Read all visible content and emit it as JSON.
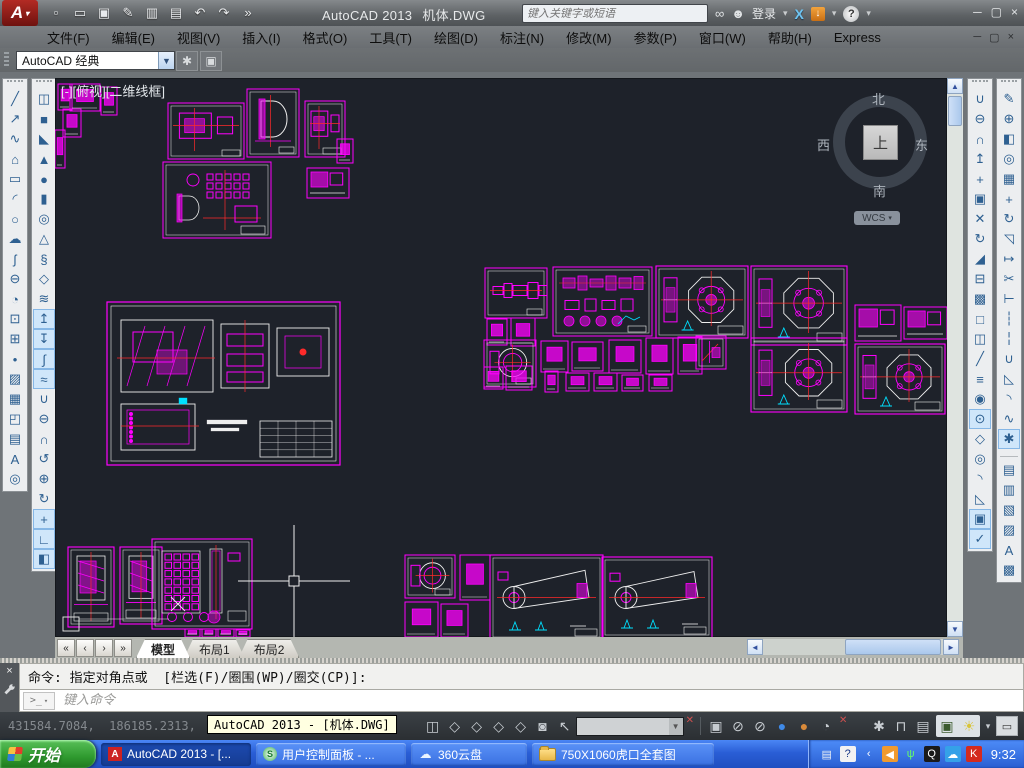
{
  "titlebar": {
    "app": "AutoCAD 2013",
    "doc": "机体.DWG",
    "search_placeholder": "键入关键字或短语",
    "signin": "登录",
    "help": "?",
    "exchange": "X",
    "quick_access": [
      {
        "name": "new",
        "g": "▫"
      },
      {
        "name": "open",
        "g": "▭"
      },
      {
        "name": "save",
        "g": "▣"
      },
      {
        "name": "save-as",
        "g": "✎"
      },
      {
        "name": "plot-preview",
        "g": "▥"
      },
      {
        "name": "plot",
        "g": "▤"
      },
      {
        "name": "undo",
        "g": "↶"
      },
      {
        "name": "redo",
        "g": "↷"
      },
      {
        "name": "more-tools",
        "g": "»"
      }
    ],
    "window_controls": [
      {
        "name": "minimize",
        "g": "─"
      },
      {
        "name": "restore",
        "g": "▢"
      },
      {
        "name": "close",
        "g": "×"
      }
    ]
  },
  "menubar": {
    "items": [
      "文件(F)",
      "编辑(E)",
      "视图(V)",
      "插入(I)",
      "格式(O)",
      "工具(T)",
      "绘图(D)",
      "标注(N)",
      "修改(M)",
      "参数(P)",
      "窗口(W)",
      "帮助(H)",
      "Express"
    ],
    "child_controls": [
      {
        "name": "child-minimize",
        "g": "─"
      },
      {
        "name": "child-restore",
        "g": "▢"
      },
      {
        "name": "child-close",
        "g": "×"
      }
    ]
  },
  "workspace": {
    "value": "AutoCAD 经典",
    "gear": "✱",
    "settings": "▣"
  },
  "toolbars": {
    "draw": [
      {
        "name": "line",
        "g": "╱"
      },
      {
        "name": "construction-line",
        "g": "↗"
      },
      {
        "name": "polyline",
        "g": "∿"
      },
      {
        "name": "polygon",
        "g": "⌂"
      },
      {
        "name": "rectangle",
        "g": "▭"
      },
      {
        "name": "arc",
        "g": "◜"
      },
      {
        "name": "circle",
        "g": "○"
      },
      {
        "name": "revision-cloud",
        "g": "☁"
      },
      {
        "name": "spline",
        "g": "ʃ"
      },
      {
        "name": "ellipse",
        "g": "⊖"
      },
      {
        "name": "ellipse-arc",
        "g": "◔"
      },
      {
        "name": "insert-block",
        "g": "⊡"
      },
      {
        "name": "make-block",
        "g": "⊞"
      },
      {
        "name": "point",
        "g": "•"
      },
      {
        "name": "hatch",
        "g": "▨"
      },
      {
        "name": "gradient",
        "g": "▦"
      },
      {
        "name": "region",
        "g": "◰"
      },
      {
        "name": "table",
        "g": "▤"
      },
      {
        "name": "multiline-text",
        "g": "A"
      },
      {
        "name": "group",
        "g": "◎"
      }
    ],
    "modeling": [
      {
        "name": "polysolid",
        "g": "◫"
      },
      {
        "name": "box",
        "g": "■"
      },
      {
        "name": "wedge",
        "g": "◣"
      },
      {
        "name": "cone",
        "g": "▲"
      },
      {
        "name": "sphere",
        "g": "●"
      },
      {
        "name": "cylinder",
        "g": "▮"
      },
      {
        "name": "torus",
        "g": "◎"
      },
      {
        "name": "pyramid",
        "g": "△"
      },
      {
        "name": "helix",
        "g": "§"
      },
      {
        "name": "planar-surface",
        "g": "◇"
      },
      {
        "name": "surface-network",
        "g": "≋"
      },
      {
        "name": "extrude",
        "g": "↥",
        "hl": true
      },
      {
        "name": "presspull",
        "g": "↧",
        "hl": true
      },
      {
        "name": "sweep",
        "g": "∫",
        "hl": true
      },
      {
        "name": "loft",
        "g": "≈",
        "hl": true
      },
      {
        "name": "union",
        "g": "∪"
      },
      {
        "name": "subtract",
        "g": "⊖"
      },
      {
        "name": "intersect",
        "g": "∩"
      },
      {
        "name": "constrained-orbit",
        "g": "↺"
      },
      {
        "name": "free-orbit",
        "g": "⊕"
      },
      {
        "name": "continuous-orbit",
        "g": "↻"
      },
      {
        "name": "3d-move",
        "g": "+",
        "hl": true
      },
      {
        "name": "3d-rotate",
        "g": "∟",
        "hl": true
      },
      {
        "name": "3d-align",
        "g": "◧",
        "hl": true
      }
    ],
    "solid_edit": [
      {
        "name": "union",
        "g": "∪"
      },
      {
        "name": "subtract",
        "g": "⊖"
      },
      {
        "name": "intersect",
        "g": "∩"
      },
      {
        "name": "extrude-faces",
        "g": "↥"
      },
      {
        "name": "move-faces",
        "g": "+"
      },
      {
        "name": "offset-faces",
        "g": "▣"
      },
      {
        "name": "delete-faces",
        "g": "✕"
      },
      {
        "name": "rotate-faces",
        "g": "↻"
      },
      {
        "name": "taper-faces",
        "g": "◢"
      },
      {
        "name": "copy-faces",
        "g": "⊟"
      },
      {
        "name": "color-faces",
        "g": "▩"
      },
      {
        "name": "shell",
        "g": "□"
      },
      {
        "name": "separate",
        "g": "◫"
      },
      {
        "name": "slice",
        "g": "╱"
      },
      {
        "name": "thicken",
        "g": "≡"
      },
      {
        "name": "interfere",
        "g": "◉"
      },
      {
        "name": "imprint",
        "g": "⊙",
        "hl": true
      },
      {
        "name": "extract-edges",
        "g": "◇"
      },
      {
        "name": "offset-edges",
        "g": "◎"
      },
      {
        "name": "fillet-edge",
        "g": "◝"
      },
      {
        "name": "chamfer-edge",
        "g": "◺"
      },
      {
        "name": "convert-to-solid",
        "g": "▣",
        "hl": true
      },
      {
        "name": "check",
        "g": "✓",
        "hl": true
      }
    ],
    "modify": [
      {
        "name": "erase",
        "g": "✎"
      },
      {
        "name": "copy",
        "g": "⊕"
      },
      {
        "name": "mirror",
        "g": "◧"
      },
      {
        "name": "offset",
        "g": "◎"
      },
      {
        "name": "array",
        "g": "▦"
      },
      {
        "name": "move",
        "g": "+"
      },
      {
        "name": "rotate",
        "g": "↻"
      },
      {
        "name": "scale",
        "g": "◹"
      },
      {
        "name": "stretch",
        "g": "↦"
      },
      {
        "name": "trim",
        "g": "✂"
      },
      {
        "name": "extend",
        "g": "⊢"
      },
      {
        "name": "break-at-point",
        "g": "┆"
      },
      {
        "name": "break",
        "g": "╎"
      },
      {
        "name": "join",
        "g": "∪"
      },
      {
        "name": "chamfer",
        "g": "◺"
      },
      {
        "name": "fillet",
        "g": "◝"
      },
      {
        "name": "blend-curves",
        "g": "∿"
      },
      {
        "name": "explode",
        "g": "✱",
        "hl": true
      }
    ],
    "draw_order": [
      {
        "name": "bring-to-front",
        "g": "▤"
      },
      {
        "name": "send-to-back",
        "g": "▥"
      },
      {
        "name": "bring-above",
        "g": "▧"
      },
      {
        "name": "send-under",
        "g": "▨"
      },
      {
        "name": "text-to-front",
        "g": "A"
      },
      {
        "name": "hatch-to-back",
        "g": "▩"
      }
    ]
  },
  "canvas": {
    "viewport_label": "[-][俯视][二维线框]",
    "viewcube": {
      "north": "北",
      "south": "南",
      "east": "东",
      "west": "西",
      "top": "上",
      "wcs": "WCS"
    },
    "colors": {
      "bg": "#1e222a",
      "magenta": "#ff00ff",
      "white": "#eeeeee",
      "red": "#ff2a2a",
      "cyan": "#00e0ff"
    },
    "crosshair": {
      "x": 239,
      "y": 503
    },
    "zoom_box": {
      "x": 8,
      "y": 539,
      "w": 16,
      "h": 14
    },
    "x_mark": {
      "x": 123,
      "y": 526
    },
    "sheets": [
      {
        "x": 3,
        "y": 6,
        "w": 14,
        "h": 26,
        "m": "tiny"
      },
      {
        "x": 15,
        "y": 6,
        "w": 30,
        "h": 27,
        "m": "tiny"
      },
      {
        "x": 46,
        "y": 9,
        "w": 16,
        "h": 28,
        "m": "tiny"
      },
      {
        "x": 8,
        "y": 31,
        "w": 18,
        "h": 28,
        "m": "tiny"
      },
      {
        "x": 0,
        "y": 52,
        "w": 10,
        "h": 38,
        "m": "tiny"
      },
      {
        "x": 113,
        "y": 25,
        "w": 76,
        "h": 56,
        "m": "views"
      },
      {
        "x": 192,
        "y": 11,
        "w": 52,
        "h": 68,
        "m": "dshape"
      },
      {
        "x": 250,
        "y": 23,
        "w": 40,
        "h": 56,
        "m": "views"
      },
      {
        "x": 282,
        "y": 61,
        "w": 16,
        "h": 24,
        "m": "tiny"
      },
      {
        "x": 108,
        "y": 84,
        "w": 108,
        "h": 76,
        "m": "views2"
      },
      {
        "x": 252,
        "y": 90,
        "w": 42,
        "h": 30,
        "m": "tinywide"
      },
      {
        "x": 52,
        "y": 224,
        "w": 233,
        "h": 163,
        "m": "assembly"
      },
      {
        "x": 430,
        "y": 190,
        "w": 62,
        "h": 50,
        "m": "shaft"
      },
      {
        "x": 432,
        "y": 241,
        "w": 20,
        "h": 26,
        "m": "tiny"
      },
      {
        "x": 456,
        "y": 240,
        "w": 24,
        "h": 28,
        "m": "tiny"
      },
      {
        "x": 498,
        "y": 189,
        "w": 99,
        "h": 69,
        "m": "parts"
      },
      {
        "x": 601,
        "y": 188,
        "w": 92,
        "h": 72,
        "m": "octagon"
      },
      {
        "x": 696,
        "y": 188,
        "w": 96,
        "h": 79,
        "m": "octagon"
      },
      {
        "x": 800,
        "y": 227,
        "w": 46,
        "h": 36,
        "m": "tinywide"
      },
      {
        "x": 849,
        "y": 229,
        "w": 43,
        "h": 32,
        "m": "tinywide"
      },
      {
        "x": 429,
        "y": 262,
        "w": 52,
        "h": 47,
        "m": "circle"
      },
      {
        "x": 486,
        "y": 263,
        "w": 27,
        "h": 31,
        "m": "tiny"
      },
      {
        "x": 517,
        "y": 264,
        "w": 31,
        "h": 29,
        "m": "tiny"
      },
      {
        "x": 554,
        "y": 262,
        "w": 32,
        "h": 33,
        "m": "tiny"
      },
      {
        "x": 591,
        "y": 260,
        "w": 27,
        "h": 36,
        "m": "tiny"
      },
      {
        "x": 623,
        "y": 259,
        "w": 24,
        "h": 37,
        "m": "tiny"
      },
      {
        "x": 641,
        "y": 258,
        "w": 30,
        "h": 33,
        "m": "diag"
      },
      {
        "x": 696,
        "y": 260,
        "w": 96,
        "h": 74,
        "m": "octagon"
      },
      {
        "x": 800,
        "y": 266,
        "w": 90,
        "h": 70,
        "m": "octagon"
      },
      {
        "x": 429,
        "y": 289,
        "w": 19,
        "h": 22,
        "m": "tiny"
      },
      {
        "x": 451,
        "y": 288,
        "w": 26,
        "h": 24,
        "m": "tiny"
      },
      {
        "x": 490,
        "y": 293,
        "w": 13,
        "h": 21,
        "m": "tiny"
      },
      {
        "x": 511,
        "y": 295,
        "w": 23,
        "h": 18,
        "m": "tiny"
      },
      {
        "x": 539,
        "y": 295,
        "w": 23,
        "h": 18,
        "m": "tiny"
      },
      {
        "x": 567,
        "y": 297,
        "w": 21,
        "h": 16,
        "m": "tiny"
      },
      {
        "x": 594,
        "y": 297,
        "w": 23,
        "h": 16,
        "m": "tiny"
      },
      {
        "x": 13,
        "y": 469,
        "w": 46,
        "h": 80,
        "m": "tallpart"
      },
      {
        "x": 65,
        "y": 469,
        "w": 42,
        "h": 77,
        "m": "tallpart"
      },
      {
        "x": 97,
        "y": 461,
        "w": 100,
        "h": 90,
        "m": "gridpart"
      },
      {
        "x": 130,
        "y": 551,
        "w": 15,
        "h": 8,
        "m": "tiny"
      },
      {
        "x": 147,
        "y": 551,
        "w": 14,
        "h": 8,
        "m": "tiny"
      },
      {
        "x": 163,
        "y": 551,
        "w": 16,
        "h": 8,
        "m": "tiny"
      },
      {
        "x": 181,
        "y": 552,
        "w": 14,
        "h": 7,
        "m": "tiny"
      },
      {
        "x": 350,
        "y": 477,
        "w": 50,
        "h": 43,
        "m": "circle"
      },
      {
        "x": 405,
        "y": 477,
        "w": 30,
        "h": 45,
        "m": "tiny"
      },
      {
        "x": 435,
        "y": 477,
        "w": 113,
        "h": 85,
        "m": "wedge"
      },
      {
        "x": 547,
        "y": 479,
        "w": 110,
        "h": 81,
        "m": "wedge"
      },
      {
        "x": 350,
        "y": 524,
        "w": 33,
        "h": 35,
        "m": "tiny"
      },
      {
        "x": 386,
        "y": 526,
        "w": 27,
        "h": 33,
        "m": "tiny"
      }
    ]
  },
  "scrollbars": {
    "up": "▲",
    "down": "▼",
    "left": "◄",
    "right": "►"
  },
  "tabs": {
    "items": [
      "模型",
      "布局1",
      "布局2"
    ],
    "active": 0,
    "nav": [
      "«",
      "‹",
      "›",
      "»"
    ]
  },
  "command": {
    "history": "命令: 指定对角点或  [栏选(F)/圈围(WP)/圈交(CP)]:",
    "prompt": ">_",
    "input_placeholder": "键入命令",
    "close": "×"
  },
  "statusbar": {
    "coords": "431584.7084,  186185.2313,  0.0000",
    "tooltip": "AutoCAD 2013 - [机体.DWG]",
    "left_icons": [
      {
        "name": "annotation-cube",
        "g": "◫"
      },
      {
        "name": "isoplane-1",
        "g": "◇"
      },
      {
        "name": "isoplane-2",
        "g": "◇"
      },
      {
        "name": "isoplane-3",
        "g": "◇"
      },
      {
        "name": "isoplane-4",
        "g": "◇"
      },
      {
        "name": "quickview-camera",
        "g": "◙"
      },
      {
        "name": "pan-zoom",
        "g": "↖"
      }
    ],
    "combo_value": "",
    "mid_icons": [
      {
        "name": "viewport-overlap",
        "g": "▣"
      },
      {
        "name": "isolate-objects",
        "g": "⊘"
      },
      {
        "name": "hide-objects",
        "g": "⊘"
      },
      {
        "name": "sphere-blue",
        "g": "●",
        "c": "#3f8ae8"
      },
      {
        "name": "sphere-orange",
        "g": "●",
        "c": "#d98a3a"
      },
      {
        "name": "annotation-scale",
        "g": "◔"
      }
    ],
    "right_icons": [
      {
        "name": "workspace-gear",
        "g": "✱"
      },
      {
        "name": "toolbar-lock",
        "g": "⊓"
      },
      {
        "name": "hardware-accel",
        "g": "▤"
      }
    ],
    "hl_icons": [
      {
        "name": "capture-check",
        "g": "▣"
      },
      {
        "name": "status-bulb",
        "g": "☀",
        "c": "#d8c43a"
      }
    ],
    "caret": "▾",
    "clean_screen": "▭"
  },
  "taskbar": {
    "start": "开始",
    "tasks": [
      {
        "label": "AutoCAD 2013 - [...",
        "icon": "acad",
        "active": true,
        "w": 150
      },
      {
        "label": "用户控制面板 - ...",
        "icon": "shield",
        "active": false,
        "w": 150
      },
      {
        "label": "360云盘",
        "icon": "cloud",
        "active": false,
        "w": 116
      },
      {
        "label": "750X1060虎口全套图",
        "icon": "folder",
        "active": false,
        "w": 182
      }
    ],
    "tray": [
      {
        "name": "keyboard",
        "g": "▤",
        "fg": "#eef2f6",
        "bg": "transparent"
      },
      {
        "name": "help-tray",
        "g": "?",
        "fg": "#1a3a8a",
        "bg": "#f2f2f2"
      },
      {
        "name": "collapse",
        "g": "‹",
        "fg": "#ffffff",
        "bg": "transparent"
      },
      {
        "name": "back-circle",
        "g": "◀",
        "fg": "#ffffff",
        "bg": "#f09a2e"
      },
      {
        "name": "wireless-signal",
        "g": "ψ",
        "fg": "#66ff66",
        "bg": "transparent"
      },
      {
        "name": "qq",
        "g": "Q",
        "fg": "#ffffff",
        "bg": "#1a1a1a"
      },
      {
        "name": "cloud-360",
        "g": "☁",
        "fg": "#ffffff",
        "bg": "#35a1e8"
      },
      {
        "name": "k-player",
        "g": "K",
        "fg": "#ffffff",
        "bg": "#d42a1e"
      }
    ],
    "time": "9:32"
  }
}
